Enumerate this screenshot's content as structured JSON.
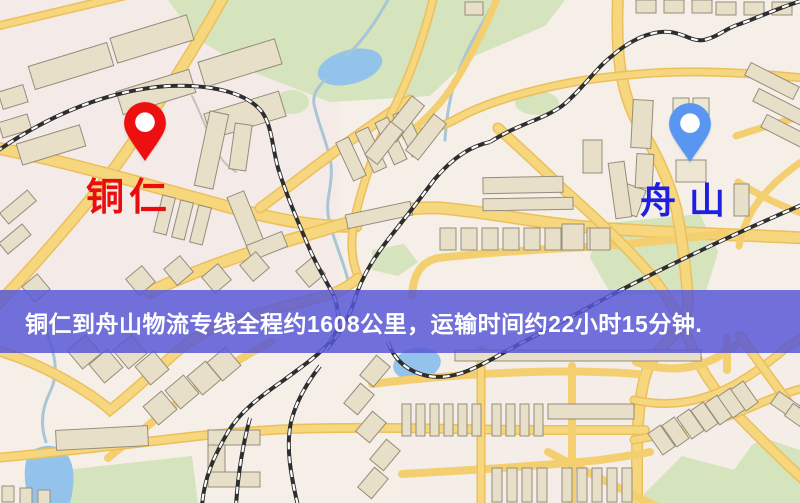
{
  "banner": {
    "text": "铜仁到舟山物流专线全程约1608公里，运输时间约22小时15分钟.",
    "bg_color": "rgba(87,87,214,0.84)",
    "text_color": "#ffffff",
    "distance_km": "1608",
    "duration": "22小时15分钟"
  },
  "markers": {
    "origin": {
      "label": "铜仁",
      "pin_color": "#ee1010",
      "label_color": "#e90d0d"
    },
    "destination": {
      "label": "舟山",
      "pin_color": "#5896f2",
      "label_color": "#1f1fe0"
    }
  },
  "map": {
    "palette": {
      "bg": "#f5efe8",
      "park": "#d5e4bc",
      "water": "#93c3ea",
      "stream": "#a9c6d6",
      "road_edge": "#ecbf5c",
      "road_fill": "#f6d77e",
      "road_minor": "#f3cf70",
      "rail": "#2e2e2e",
      "rail_dash": "#ffffff",
      "building": "#e7dfc8",
      "building_pale": "#ece6d3",
      "building_stroke": "#958d7c"
    },
    "zones": [
      [
        0,
        0,
        800,
        503,
        "#f5efe8",
        1
      ],
      [
        0,
        0,
        340,
        300,
        "#f4e7e7",
        0.5
      ],
      [
        400,
        340,
        400,
        163,
        "#f4eae6",
        0.4
      ]
    ],
    "parks": [
      {
        "pts": "168,0 565,0 545,26 470,58 430,96 330,102 248,70 196,38"
      },
      {
        "cx": 537,
        "cy": 103,
        "rx": 22,
        "ry": 12
      },
      {
        "cx": 292,
        "cy": 102,
        "rx": 17,
        "ry": 12
      },
      {
        "pts": "598,224 700,214 718,252 706,292 612,296 590,258"
      },
      {
        "pts": "46,472 192,456 198,503 42,503"
      },
      {
        "pts": "636,503 646,492 682,456 734,470 752,445 764,438 800,450 800,503"
      },
      {
        "pts": "372,250 404,244 418,262 398,276 372,270"
      }
    ],
    "waters": [
      {
        "cx": 350,
        "cy": 67,
        "rx": 33,
        "ry": 17,
        "tr": "rotate(-15 350 67)"
      },
      {
        "d": "M30,452 C42,444 58,442 68,456 C76,468 74,488 70,503 L30,503 C24,486 22,464 30,452 Z"
      },
      {
        "cx": 417,
        "cy": 364,
        "rx": 24,
        "ry": 16,
        "tr": "rotate(-10 417 364)"
      }
    ],
    "streams": [
      {
        "d": "M390,-4 C374,26 360,44 346,56"
      },
      {
        "d": "M325,80 C315,90 313,96 314,104 C318,124 328,144 331,164 C333,184 326,198 328,214 C331,234 341,254 348,280"
      },
      {
        "d": "M46,330 C54,352 60,372 50,392 C42,408 40,425 46,442"
      },
      {
        "d": "M498,-4 C478,30 460,60 452,92 C448,108 446,124 445,140"
      },
      {
        "d": "M192,96 C200,112 206,128 212,142 C218,156 226,166 236,172",
        "c": "#c6c1b6",
        "w": 2
      }
    ],
    "roads": [
      {
        "d": "M-2,26 L124,-4",
        "w": 9
      },
      {
        "d": "M224,-4 C202,36 178,74 158,104 C140,132 120,162 96,192 C62,234 28,272 -4,306",
        "w": 12
      },
      {
        "d": "M-4,148 C70,162 150,186 240,210 C280,220 320,228 356,226",
        "w": 13
      },
      {
        "d": "M260,208 C290,186 330,154 368,128 C384,117 396,108 410,100",
        "w": 11
      },
      {
        "d": "M150,292 C200,268 250,252 310,234 C360,219 400,206 440,208 C490,212 540,224 600,228 C660,233 730,234 804,238",
        "w": 13
      },
      {
        "d": "M412,296 C413,276 420,262 438,258 C500,251 556,249 602,246 C652,242 692,238 726,233",
        "w": 8
      },
      {
        "d": "M618,-4 C616,44 618,84 636,120 C656,152 670,182 677,212 C682,240 686,268 688,300 C689,324 668,338 652,360 C640,380 637,420 637,460 L637,506",
        "w": 12
      },
      {
        "d": "M498,128 C520,148 542,168 562,188 C596,218 626,246 650,274 C670,298 682,322 692,348 C704,378 724,402 748,426 C768,446 786,464 804,480",
        "w": 11
      },
      {
        "d": "M804,78 C740,72 690,70 640,74 C600,77 570,82 545,88 C510,96 480,106 458,118 C440,128 424,132 406,136",
        "w": 9
      },
      {
        "d": "M434,-4 C424,36 412,72 394,108 C376,146 362,184 354,222 C350,244 352,262 358,276",
        "w": 9
      },
      {
        "d": "M498,-4 C484,32 468,62 450,90 C436,110 420,124 406,136",
        "w": 7
      },
      {
        "d": "M736,136 C760,128 780,122 804,116",
        "w": 7
      },
      {
        "d": "M738,182 C760,196 780,206 804,214",
        "w": 7
      },
      {
        "d": "M804,160 C786,172 770,186 758,202 C748,216 742,230 739,246",
        "w": 7
      },
      {
        "d": "M-4,350 C30,360 62,376 92,396 C100,402 106,406 110,410 C128,396 150,376 172,356 C192,338 210,328 230,322 C256,314 286,306 318,298 C334,294 346,288 358,278",
        "w": 11
      },
      {
        "d": "M108,458 C135,436 165,411 200,386 C226,367 250,353 272,341",
        "w": 8
      },
      {
        "d": "M-4,458 C60,452 120,445 180,438 C240,431 290,428 340,428 C400,427 470,430 540,430 C580,430 610,430 645,430",
        "w": 10
      },
      {
        "d": "M372,384 C420,378 470,374 530,372 C570,371 610,372 638,374",
        "w": 8
      },
      {
        "d": "M402,474 C470,470 540,466 600,460 C620,457 636,455 650,452",
        "w": 8
      },
      {
        "d": "M481,350 L481,506",
        "w": 9
      },
      {
        "d": "M572,366 L572,506",
        "w": 8
      },
      {
        "d": "M727,338 L727,370",
        "w": 8
      },
      {
        "d": "M636,362 C665,372 692,370 716,358 C730,350 738,344 744,338",
        "w": 8
      },
      {
        "d": "M634,400 C670,408 700,402 732,386 C754,374 772,360 786,348 C792,344 798,340 804,336",
        "w": 9
      },
      {
        "d": "M634,440 C680,432 722,420 754,406 C772,398 788,392 804,388",
        "w": 9
      },
      {
        "d": "M740,336 C756,358 772,380 788,402 C794,410 800,418 804,424",
        "w": 10
      },
      {
        "d": "M548,452 C582,470 618,487 656,506",
        "w": 8
      }
    ],
    "rails": [
      "M-4,152 C50,114 110,90 168,86 C215,84 248,94 262,112 C272,126 272,146 278,168 C286,194 298,222 310,250 C320,272 328,284 334,296",
      "M334,296 C340,314 340,330 330,342 C318,356 300,368 284,380 C258,398 240,412 228,432 C214,456 204,478 202,506",
      "M250,418 C243,444 238,472 236,506",
      "M320,366 C306,384 296,402 291,422 C286,446 290,472 298,506",
      "M326,350 C338,336 348,320 354,302 C362,274 378,252 394,232 C410,212 422,196 434,180 C454,156 472,146 490,142",
      "M490,142 C518,124 542,120 562,106 C582,90 596,68 612,56 C630,40 652,30 670,32 C686,34 692,42 704,40 C718,37 726,28 740,24 C762,16 778,8 804,0",
      "M388,342 C394,360 408,372 428,376 C452,380 472,370 494,358 C522,342 562,322 602,300 C662,268 738,232 804,204"
    ],
    "buildings": [
      [
        30,
        54,
        82,
        24,
        -17
      ],
      [
        112,
        26,
        80,
        26,
        -17
      ],
      [
        118,
        80,
        76,
        24,
        -17
      ],
      [
        200,
        50,
        80,
        26,
        -17
      ],
      [
        206,
        102,
        78,
        26,
        -17
      ],
      [
        18,
        134,
        66,
        22,
        -17
      ],
      [
        0,
        88,
        26,
        18,
        -17
      ],
      [
        0,
        118,
        30,
        16,
        -17
      ],
      [
        0,
        200,
        36,
        14,
        -40
      ],
      [
        0,
        232,
        30,
        14,
        -40
      ],
      [
        202,
        112,
        19,
        76,
        12
      ],
      [
        232,
        124,
        17,
        46,
        8
      ],
      [
        158,
        196,
        13,
        38,
        14
      ],
      [
        176,
        201,
        13,
        38,
        14
      ],
      [
        194,
        206,
        13,
        38,
        14
      ],
      [
        238,
        192,
        18,
        62,
        -22
      ],
      [
        248,
        238,
        38,
        16,
        -22
      ],
      [
        344,
        138,
        14,
        42,
        -25
      ],
      [
        364,
        128,
        14,
        44,
        -25
      ],
      [
        384,
        118,
        14,
        46,
        -25
      ],
      [
        402,
        110,
        14,
        46,
        -25
      ],
      [
        346,
        208,
        66,
        14,
        -12
      ],
      [
        396,
        96,
        16,
        46,
        38
      ],
      [
        418,
        114,
        16,
        46,
        38
      ],
      [
        376,
        122,
        16,
        42,
        38
      ],
      [
        465,
        2,
        18,
        13,
        0
      ],
      [
        636,
        0,
        20,
        13,
        0
      ],
      [
        664,
        0,
        20,
        13,
        0
      ],
      [
        692,
        0,
        20,
        13,
        0
      ],
      [
        716,
        2,
        20,
        13,
        0
      ],
      [
        744,
        2,
        20,
        13,
        0
      ],
      [
        772,
        2,
        20,
        13,
        0
      ],
      [
        483,
        177,
        80,
        16,
        -1
      ],
      [
        483,
        198,
        90,
        12,
        -1
      ],
      [
        440,
        228,
        16,
        22,
        0
      ],
      [
        461,
        228,
        16,
        22,
        0
      ],
      [
        482,
        228,
        16,
        22,
        0
      ],
      [
        503,
        228,
        16,
        22,
        0
      ],
      [
        524,
        228,
        16,
        22,
        0
      ],
      [
        545,
        228,
        16,
        22,
        0
      ],
      [
        566,
        228,
        16,
        22,
        0
      ],
      [
        587,
        228,
        16,
        22,
        0
      ],
      [
        583,
        140,
        19,
        33,
        0
      ],
      [
        620,
        186,
        22,
        28,
        20
      ],
      [
        632,
        100,
        20,
        48,
        3
      ],
      [
        636,
        154,
        17,
        34,
        3
      ],
      [
        612,
        162,
        16,
        56,
        -8
      ],
      [
        673,
        98,
        16,
        22,
        0,
        1
      ],
      [
        693,
        98,
        16,
        22,
        0,
        1
      ],
      [
        676,
        160,
        30,
        22,
        0,
        1
      ],
      [
        562,
        224,
        22,
        26,
        0
      ],
      [
        590,
        228,
        20,
        22,
        0
      ],
      [
        745,
        74,
        54,
        14,
        27
      ],
      [
        753,
        100,
        54,
        14,
        27
      ],
      [
        761,
        126,
        54,
        14,
        27
      ],
      [
        734,
        184,
        15,
        32,
        0
      ],
      [
        130,
        270,
        21,
        21,
        -40
      ],
      [
        168,
        260,
        21,
        21,
        -40
      ],
      [
        206,
        268,
        21,
        21,
        -40
      ],
      [
        244,
        256,
        21,
        21,
        -40
      ],
      [
        300,
        262,
        21,
        21,
        -40
      ],
      [
        26,
        278,
        20,
        20,
        -40
      ],
      [
        72,
        340,
        24,
        24,
        -40
      ],
      [
        94,
        354,
        24,
        24,
        -40
      ],
      [
        118,
        340,
        24,
        24,
        -40
      ],
      [
        140,
        356,
        24,
        24,
        -40
      ],
      [
        148,
        396,
        24,
        24,
        -40
      ],
      [
        170,
        380,
        24,
        24,
        -40
      ],
      [
        192,
        366,
        24,
        24,
        -40
      ],
      [
        212,
        352,
        24,
        24,
        -40
      ],
      [
        366,
        358,
        18,
        26,
        40
      ],
      [
        350,
        386,
        18,
        26,
        40
      ],
      [
        362,
        414,
        18,
        26,
        40
      ],
      [
        376,
        442,
        18,
        26,
        40
      ],
      [
        364,
        470,
        18,
        26,
        40
      ],
      [
        56,
        428,
        92,
        20,
        -3
      ],
      [
        208,
        430,
        52,
        15,
        0
      ],
      [
        208,
        445,
        17,
        32,
        0
      ],
      [
        208,
        472,
        52,
        15,
        0
      ],
      [
        2,
        486,
        12,
        16,
        0
      ],
      [
        20,
        488,
        12,
        16,
        0
      ],
      [
        38,
        490,
        12,
        16,
        0
      ],
      [
        455,
        350,
        246,
        11,
        0
      ],
      [
        548,
        404,
        86,
        15,
        0
      ],
      [
        402,
        404,
        9,
        32,
        0
      ],
      [
        416,
        404,
        9,
        32,
        0
      ],
      [
        430,
        404,
        9,
        32,
        0
      ],
      [
        444,
        404,
        9,
        32,
        0
      ],
      [
        458,
        404,
        9,
        32,
        0
      ],
      [
        472,
        404,
        9,
        32,
        0
      ],
      [
        492,
        404,
        9,
        32,
        0
      ],
      [
        506,
        404,
        9,
        32,
        0
      ],
      [
        520,
        404,
        9,
        32,
        0
      ],
      [
        534,
        404,
        9,
        32,
        0
      ],
      [
        492,
        468,
        10,
        34,
        0
      ],
      [
        507,
        468,
        10,
        34,
        0
      ],
      [
        522,
        468,
        10,
        34,
        0
      ],
      [
        537,
        468,
        10,
        34,
        0
      ],
      [
        562,
        468,
        10,
        34,
        0
      ],
      [
        577,
        468,
        10,
        34,
        0
      ],
      [
        592,
        468,
        10,
        34,
        0
      ],
      [
        607,
        468,
        10,
        34,
        0
      ],
      [
        622,
        468,
        10,
        34,
        0
      ],
      [
        654,
        427,
        15,
        26,
        -35
      ],
      [
        668,
        419,
        15,
        26,
        -35
      ],
      [
        683,
        411,
        15,
        26,
        -35
      ],
      [
        697,
        404,
        15,
        26,
        -35
      ],
      [
        711,
        397,
        15,
        26,
        -35
      ],
      [
        724,
        390,
        15,
        26,
        -35
      ],
      [
        737,
        383,
        15,
        26,
        -35
      ],
      [
        778,
        392,
        15,
        26,
        -55
      ],
      [
        792,
        404,
        15,
        26,
        -55
      ]
    ]
  }
}
